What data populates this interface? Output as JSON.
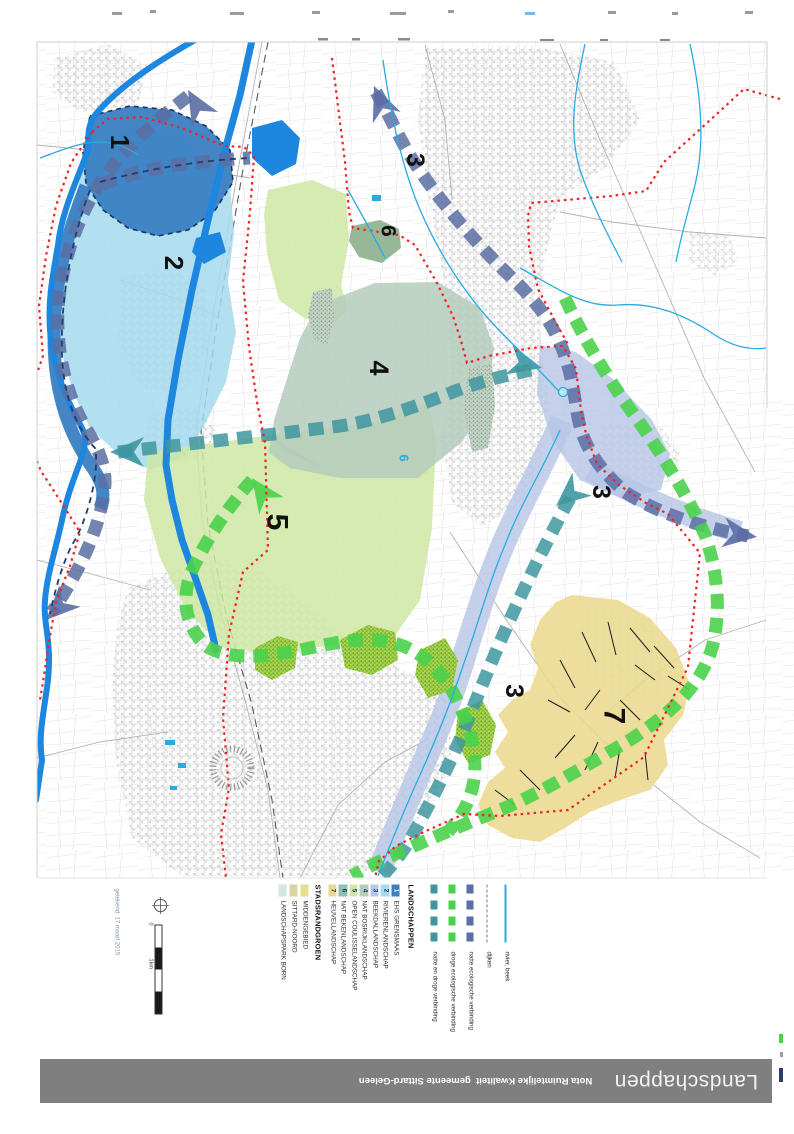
{
  "footer": {
    "title": "Landschappen",
    "subtitle": "Nota Ruimtelijke Kwaliteit  gemeente Sittard-Geleen",
    "bar_color": "#7f7f7f"
  },
  "legend": {
    "line_items": [
      {
        "label": "rivier, beek",
        "symbol": "line-solid",
        "color": "#29abe2"
      },
      {
        "label": "dijken",
        "symbol": "line-dashdot",
        "color": "#777777"
      },
      {
        "label": "natte ecologische verbinding",
        "symbol": "band-dashed",
        "color": "#5a6ea3"
      },
      {
        "label": "droge ecologische verbinding",
        "symbol": "band-dashed",
        "color": "#4bd24b"
      },
      {
        "label": "natte en droge verbinding",
        "symbol": "band-dashed",
        "color": "#3f96a0"
      }
    ],
    "landschappen": {
      "header": "LANDSCHAPPEN",
      "items": [
        {
          "num": "1",
          "label": "EHS GRENSMAAS",
          "color": "#3a7fc2",
          "num_color": "#ffffff"
        },
        {
          "num": "2",
          "label": "RIVIERENLANDSCHAP",
          "color": "#a6dbee",
          "num_color": "#12395f"
        },
        {
          "num": "3",
          "label": "BEEKDALLANDSCHAP",
          "color": "#b7c6e6",
          "num_color": "#12395f"
        },
        {
          "num": "4",
          "label": "NAT BOSRIJKLANDSCHAP",
          "color": "#b5cbbd",
          "num_color": "#12395f"
        },
        {
          "num": "5",
          "label": "OPEN COULISSELANDSCHAP",
          "color": "#cfe7a4",
          "num_color": "#12395f"
        },
        {
          "num": "6",
          "label": "NAT BEKENLANDSCHAP",
          "color": "#8fbfae",
          "num_color": "#12395f"
        },
        {
          "num": "7",
          "label": "HEUVELLANDSCHAP",
          "color": "#ead98f",
          "num_color": "#12395f"
        }
      ]
    },
    "stadsrandgroen": {
      "header": "STADSRANDGROEN",
      "items": [
        {
          "label": "MIDDENGEBIED",
          "color": "#e6de8d",
          "texture": "solid"
        },
        {
          "label": "SITTARD-NOORD",
          "color": "#d9d3a8",
          "texture": "dots"
        },
        {
          "label": "LANDSCHAPSPARK BORN",
          "color": "#cfe9dc",
          "texture": "dots"
        }
      ]
    },
    "scale": {
      "zero": "0",
      "km": "1km",
      "segments": [
        "#ffffff",
        "#1a1a1a",
        "#ffffff",
        "#1a1a1a"
      ]
    },
    "date_note": "getekend: 17 maart 2015"
  },
  "map": {
    "colors": {
      "river": "#1d87e0",
      "stream": "#29abe2",
      "boundary_red": "#ee2222",
      "ribbon_wet": "#5a6ea3",
      "ribbon_dry": "#4bd24b",
      "ribbon_wetdry": "#3f96a0"
    },
    "labels": [
      {
        "text": "1",
        "x": 120,
        "y": 142,
        "size": 26,
        "color": "#111111"
      },
      {
        "text": "2",
        "x": 174,
        "y": 263,
        "size": 26,
        "color": "#111111"
      },
      {
        "text": "3",
        "x": 415,
        "y": 160,
        "size": 25,
        "color": "#111111"
      },
      {
        "text": "6",
        "x": 388,
        "y": 231,
        "size": 21,
        "color": "#111111"
      },
      {
        "text": "4",
        "x": 379,
        "y": 368,
        "size": 27,
        "color": "#111111"
      },
      {
        "text": "5",
        "x": 277,
        "y": 522,
        "size": 30,
        "color": "#111111"
      },
      {
        "text": "3",
        "x": 601,
        "y": 492,
        "size": 25,
        "color": "#111111"
      },
      {
        "text": "3",
        "x": 514,
        "y": 691,
        "size": 25,
        "color": "#111111"
      },
      {
        "text": "7",
        "x": 614,
        "y": 716,
        "size": 30,
        "color": "#111111"
      },
      {
        "text": "6",
        "x": 404,
        "y": 458,
        "size": 13,
        "color": "#29abe2"
      }
    ]
  }
}
